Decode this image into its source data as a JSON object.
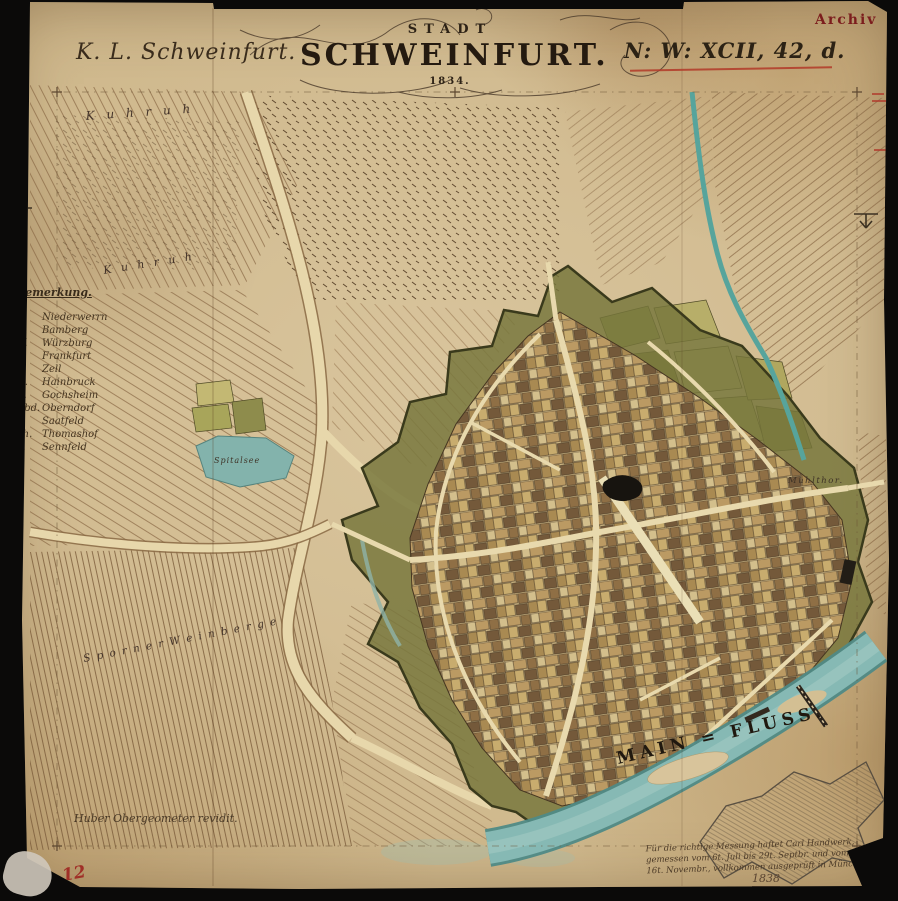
{
  "stamp": {
    "archiv": "Archiv"
  },
  "header": {
    "left_title": "K. L. Schweinfurt.",
    "cartouche": {
      "line1": "STADT",
      "line2": "SCHWEINFURT.",
      "year": "1834."
    },
    "right_code": "N: W: XCII, 42, d."
  },
  "legend": {
    "title": "Bemerkung.",
    "entries": [
      {
        "abbr": "N.",
        "name": "Niederwerrn"
      },
      {
        "abbr": "B.",
        "name": "Bamberg"
      },
      {
        "abbr": "W.",
        "name": "Würzburg"
      },
      {
        "abbr": "F.",
        "name": "Frankfurt"
      },
      {
        "abbr": "Z.",
        "name": "Zell"
      },
      {
        "abbr": "H.",
        "name": "Hainbruck"
      },
      {
        "abbr": "G.",
        "name": "Gochsheim"
      },
      {
        "abbr": "Obd.",
        "name": "Oberndorf"
      },
      {
        "abbr": "S.",
        "name": "Saatfeld"
      },
      {
        "abbr": "Th.",
        "name": "Thomashof"
      },
      {
        "abbr": "S.",
        "name": "Sennfeld"
      }
    ]
  },
  "map_labels": {
    "kuhruh_north": "K u h r u h",
    "kuhruh_mid": "K u h r u h",
    "spitalsee": "Spitalsee",
    "muehlthor": "Mühlthor.",
    "sporner_weinberge": "S p o r n e r   W e i n b e r g e",
    "main_fluss": "MAIN = FLUSS."
  },
  "footer": {
    "surveyor_note": "Huber Obergeometer revidit.",
    "certification_note_line1": "Für die richtige Messung haftet Carl Handwerk,",
    "certification_note_line2": "gemessen vom 6t. Juli bis 29t. Septbr. und vom 6t. bis",
    "certification_note_line3": "16t. Novembr., vollkommen ausgeprüft in München.",
    "certification_year": "1838",
    "sheet_number": "12"
  },
  "colors": {
    "paper": "#d3bd93",
    "ink": "#3a2c1c",
    "red_accent": "#b23a28",
    "stamp_red": "#7c1d1d",
    "water": "#86b9b4",
    "rampart_green": "#75753a",
    "parcel_tan": "#bb9a63",
    "parcel_brown": "#74593a"
  }
}
